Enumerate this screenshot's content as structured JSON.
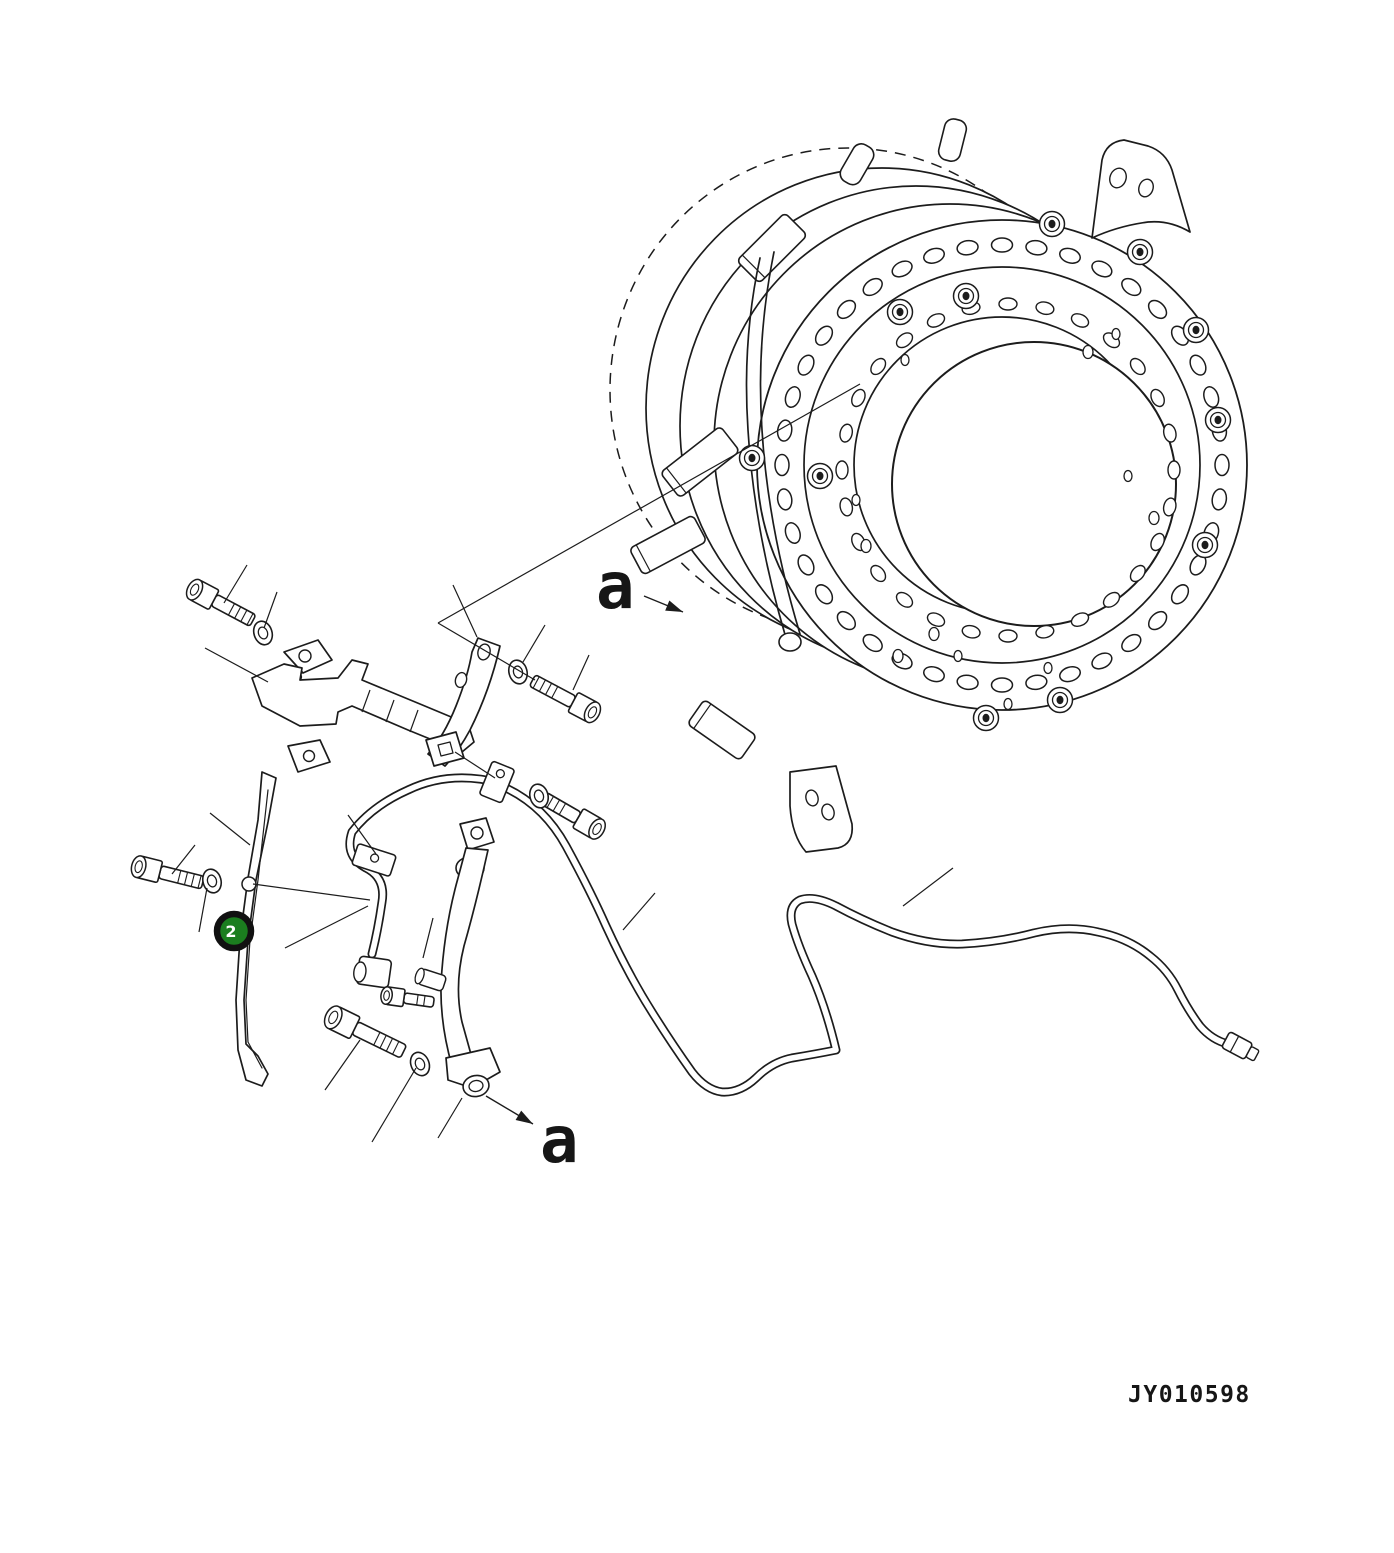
{
  "figure": {
    "background": "#ffffff",
    "line_color": "#1c1c1c",
    "callout": {
      "label": "2",
      "fill": "#1b7e1f",
      "ring_color": "#111111",
      "text_color": "#ffffff"
    },
    "section_labels": [
      {
        "text": "a"
      },
      {
        "text": "a"
      }
    ],
    "drawing_number": {
      "text": "JY010598"
    },
    "assembly": {
      "outer_hole_count": 40,
      "inner_hole_count": 28
    }
  }
}
